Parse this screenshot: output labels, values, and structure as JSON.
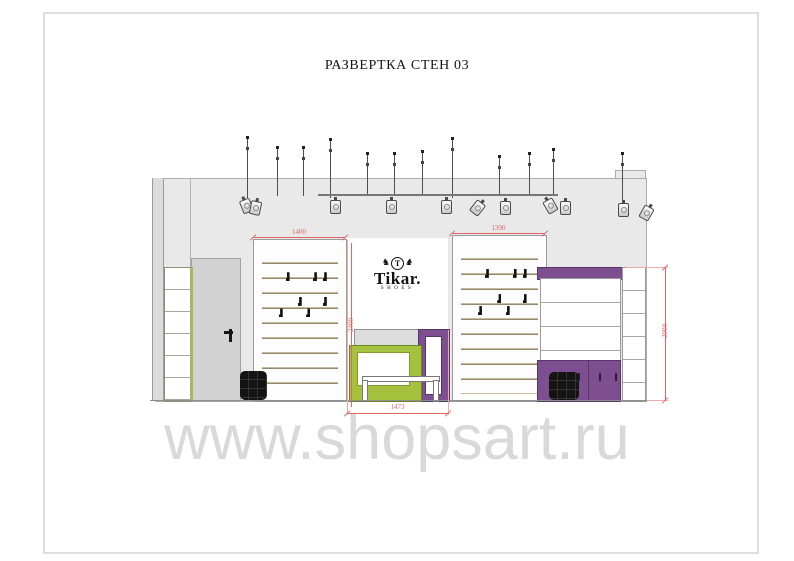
{
  "page": {
    "title": "РАЗВЕРТКА СТЕН 03",
    "watermark": "www.shopsart.ru"
  },
  "logo": {
    "brand": "Tikar.",
    "sub": "SHOES",
    "monogram": "T"
  },
  "dimensions": {
    "left_unit_width": "1400",
    "right_unit_width": "1390",
    "cash_desk_width": "1473",
    "left_wall_height": "2400",
    "right_cabinet_height": "2000"
  },
  "colors": {
    "accent_green": "#a5c13e",
    "accent_purple": "#7e4f90",
    "dimension_red": "#e06666",
    "wall_gray": "#e9e9e9",
    "door_gray": "#d2d2d2"
  },
  "drawing": {
    "track": {
      "x": 318,
      "y": 194,
      "width": 240
    },
    "rods": [
      {
        "x": 247,
        "top": 136,
        "bottom": 198
      },
      {
        "x": 277,
        "top": 146,
        "bottom": 196
      },
      {
        "x": 303,
        "top": 146,
        "bottom": 196
      },
      {
        "x": 330,
        "top": 138,
        "bottom": 198
      },
      {
        "x": 367,
        "top": 152,
        "bottom": 196
      },
      {
        "x": 394,
        "top": 152,
        "bottom": 196
      },
      {
        "x": 422,
        "top": 150,
        "bottom": 196
      },
      {
        "x": 452,
        "top": 137,
        "bottom": 198
      },
      {
        "x": 499,
        "top": 155,
        "bottom": 196
      },
      {
        "x": 529,
        "top": 152,
        "bottom": 196
      },
      {
        "x": 553,
        "top": 148,
        "bottom": 196
      },
      {
        "x": 622,
        "top": 152,
        "bottom": 202
      }
    ],
    "spotlights": [
      {
        "x": 241,
        "y": 199,
        "rot": -22
      },
      {
        "x": 250,
        "y": 201,
        "rot": 12
      },
      {
        "x": 330,
        "y": 200,
        "rot": 0
      },
      {
        "x": 386,
        "y": 200,
        "rot": 0
      },
      {
        "x": 441,
        "y": 200,
        "rot": 0
      },
      {
        "x": 472,
        "y": 201,
        "rot": 38
      },
      {
        "x": 500,
        "y": 201,
        "rot": 0
      },
      {
        "x": 545,
        "y": 199,
        "rot": -30
      },
      {
        "x": 560,
        "y": 201,
        "rot": 0
      },
      {
        "x": 618,
        "y": 203,
        "rot": 0
      },
      {
        "x": 641,
        "y": 206,
        "rot": 30
      }
    ],
    "shoe_positions": [
      {
        "x": 31,
        "y": 16
      },
      {
        "x": 67,
        "y": 16
      },
      {
        "x": 80,
        "y": 16
      },
      {
        "x": 47,
        "y": 33
      },
      {
        "x": 80,
        "y": 33
      },
      {
        "x": 22,
        "y": 41
      },
      {
        "x": 58,
        "y": 41
      }
    ]
  }
}
